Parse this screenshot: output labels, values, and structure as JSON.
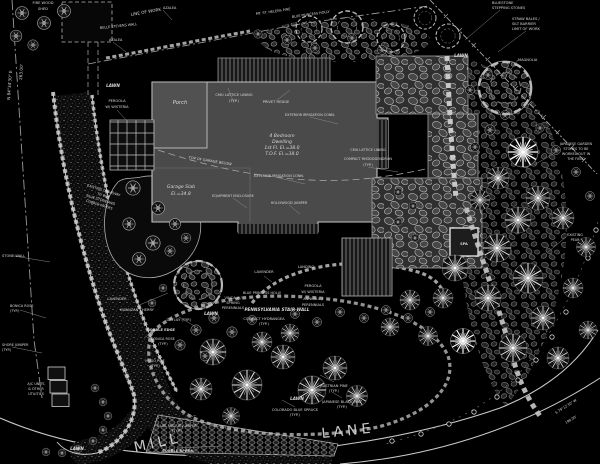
{
  "plan": {
    "type": "residential landscape site plan",
    "colors": {
      "background": "#000000",
      "linework": "#c8c8c8",
      "house_fill": "#4a4a4a",
      "house_outline": "#c3c3c3",
      "text": "#d9d9d9"
    }
  },
  "street": {
    "mill": "MILL",
    "lane": "LANE"
  },
  "labels": {
    "shed_l1": "FIRE WOOD",
    "shed_l2": "SHED",
    "bearing_left": "N 84°34'30\" E",
    "distance_left": "263.00'",
    "line_of_work": "LINE OF WORK",
    "mt_st_pine": "MT. ST. HELENS PINE",
    "blue_princess_holly": "BLUE PRINCESS HOLLY",
    "belle_stevens_wall": "BELLE STEVENS WALL",
    "azalea": "AZALEA",
    "straw_l1": "STRAW BALES /",
    "straw_l2": "SILT BARRIER",
    "straw_l3": "LIMIT OF WORK",
    "stepping_l1": "BLUESTONE",
    "stepping_l2": "STEPPING STONES",
    "magnolia": "MAGNOLIA",
    "lawn": "LAWN",
    "pergola_l1": "PERGOLA",
    "pergola_l2": "W/ WISTERIA",
    "porch": "Porch",
    "dwelling_l1": "4 Bedroom",
    "dwelling_l2": "Dwelling",
    "dwelling_l3": "1st Fl. El.=38.0",
    "dwelling_l4": "T.O.F. El.=38.0",
    "garage_l1": "Garage Slab",
    "garage_l2": "El.=34.8",
    "cmu_lattice": "CMU LATTICE LINING",
    "typ": "(TYP.)",
    "privet_hedge": "PRIVET HEDGE",
    "irrigation": "EXTERIOR IRRIGATION CONN.",
    "compact_rhodo": "COMPACT RHODODENDRON",
    "top_of_garage": "TOP OF GARAGE BELOW",
    "equipment": "EQUIPMENT ENCLOSURE",
    "hollywood_juniper": "HOLLYWOOD JUNIPER",
    "landing": "LANDING",
    "lavender": "LAVENDER",
    "vinca_l1": "VINCA W/",
    "vinca_l2": "SPRING",
    "vinca_l3": "PERENNIALS",
    "penn_stair_wall": "PENNSYLVANIA STAIR WALL",
    "annuals_l1": "ANNUALS /",
    "annuals_l2": "PERENNIALS",
    "hydrangea": "COMPACT HYDRANGEA",
    "kwanzan_cherry": "KWANZAN CHERRY",
    "daylily": "DAYLILY (TYP.)",
    "cobble_edge": "COBBLE EDGE",
    "bonica_rose": "BONICA ROSE",
    "mugo_pine": "MUGO PINE",
    "stone_wall": "STONE WALL",
    "shore_juniper": "SHORE JUNIPER",
    "ac_l1": "A/C UNITS",
    "ac_l2": "& OTHER",
    "ac_l3": "UTILITIES",
    "drive_l1": "EXISTING DRIVEWAY",
    "drive_l2": "TO BE",
    "drive_l3": "BLUE STONE AND",
    "drive_l4": "COBBLE PAVERS",
    "blue_pacific": "BLUE PACIFIC JUNIPER",
    "cobble_apron": "COBBLE APRON",
    "austrian_pine": "AUSTRIAN PINE",
    "jap_black_pine": "JAPANESE BLACK PINE",
    "colorado_spruce": "COLORADO BLUE SPRUCE",
    "jgs_l1": "JAPANESE GARDEN",
    "jgs_l2": "STONES TO BE",
    "jgs_l3": "WORKED OUT IN",
    "jgs_l4": "THE FIELD",
    "pear_l1": "EXISTING",
    "pear_l2": "PEAR",
    "spa": "SPA",
    "bearing_bottom": "S 79°12'30\" W",
    "distance_bottom": "198.00'"
  }
}
